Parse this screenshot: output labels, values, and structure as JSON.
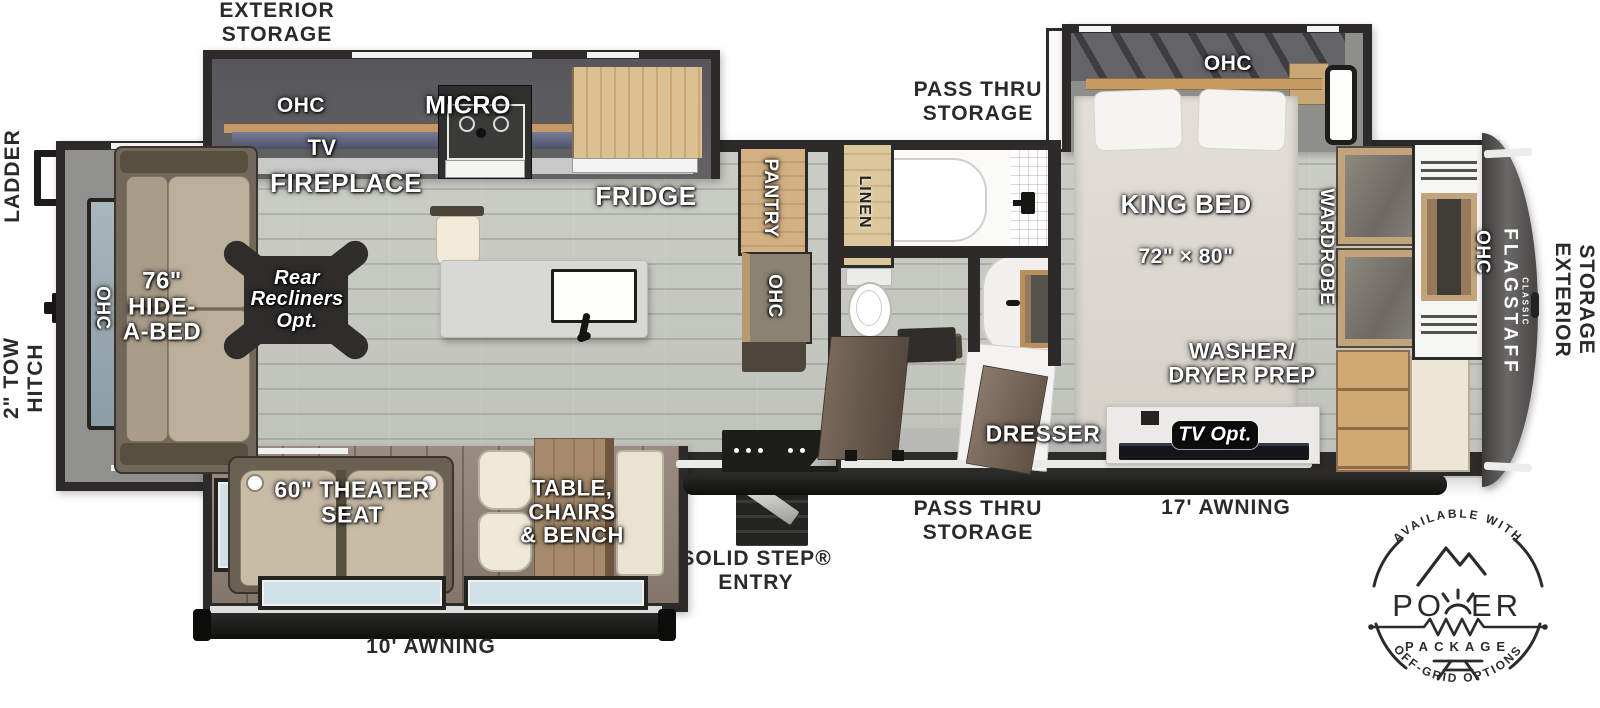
{
  "colors": {
    "floor": "#c6c8c1",
    "slide_floor_wood": "#93857a",
    "wall": "#2c2b29",
    "cabinet_wood": "#cfa873",
    "awning_black": "#1b1b19",
    "window_glass": "#cfe0e6",
    "upholstery": "#bfb3a0",
    "label_white": "#ffffff",
    "label_black": "#2a2a2a"
  },
  "exterior": {
    "exterior_storage_rear": "EXTERIOR\nSTORAGE",
    "ladder": "LADDER",
    "tow_hitch": "2\" TOW\nHITCH",
    "pass_thru_storage_top": "PASS THRU\nSTORAGE",
    "exterior_storage_front": "EXTERIOR\nSTORAGE",
    "pass_thru_storage_bottom": "PASS THRU\nSTORAGE",
    "awning_17": "17' AWNING",
    "solid_step_entry": "SOLID STEP®\nENTRY",
    "awning_10": "10' AWNING"
  },
  "living": {
    "ohc_rear": "OHC",
    "hide_a_bed": "76\"\nHIDE-\nA-BED",
    "recliners_opt": "Rear\nRecliners\nOpt.",
    "tv": "TV",
    "fireplace": "FIREPLACE",
    "theater_seat": "60\" THEATER\nSEAT",
    "table_chairs": "TABLE,\nCHAIRS\n& BENCH"
  },
  "kitchen": {
    "ohc": "OHC",
    "micro": "MICRO",
    "fridge": "FRIDGE",
    "pantry": "PANTRY",
    "pantry_ohc": "OHC"
  },
  "bath": {
    "linen": "LINEN"
  },
  "bedroom": {
    "ohc": "OHC",
    "king_bed": "KING BED",
    "king_bed_size": "72\" × 80\"",
    "wardrobe": "WARDROBE",
    "washer_dryer": "WASHER/\nDRYER PREP",
    "dresser": "DRESSER",
    "tv_opt": "TV Opt."
  },
  "front": {
    "ohc": "OHC",
    "brand": "FLAGSTAFF",
    "brand_sub": "CLASSIC"
  },
  "badge": {
    "available": "AVAILABLE WITH",
    "power_left": "PO",
    "power_right": "ER",
    "package": "PACKAGE",
    "offgrid": "OFF-GRID OPTIONS"
  }
}
